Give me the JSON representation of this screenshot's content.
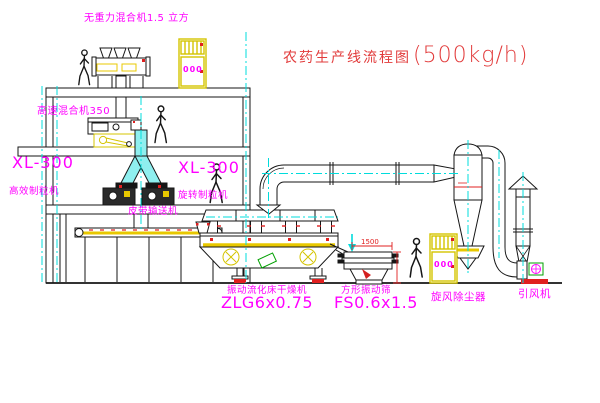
{
  "title": {
    "name": "农药生产线流程图",
    "capacity": "(500kg/h)"
  },
  "labels": {
    "gravity_mixer": "无重力混合机1.5 立方",
    "high_speed_mixer": "高速混合机350",
    "granulator_left": {
      "model": "XL-300",
      "name": "高效制粒机"
    },
    "granulator_middle": {
      "model": "XL-300",
      "name": "旋转制粒机"
    },
    "belt_conveyor": "皮带输送机",
    "dryer": {
      "name": "振动流化床干燥机",
      "model": "ZLG6x0.75"
    },
    "screen": {
      "name": "方形振动筛",
      "model": "FS0.6x1.5"
    },
    "cyclone": "旋风除尘器",
    "fan": "引风机"
  },
  "control_panels": {
    "panel_top_display": "000",
    "panel_right_display": "000"
  },
  "dimensions": {
    "screen_length": "1500"
  },
  "colors": {
    "label_magenta": "#ff00ff",
    "title_red": "#e23b3b",
    "centerline_cyan": "#00dcdc",
    "equipment_yellow": "#e8c800",
    "accent_red": "#e02020",
    "line_black": "#161616"
  }
}
